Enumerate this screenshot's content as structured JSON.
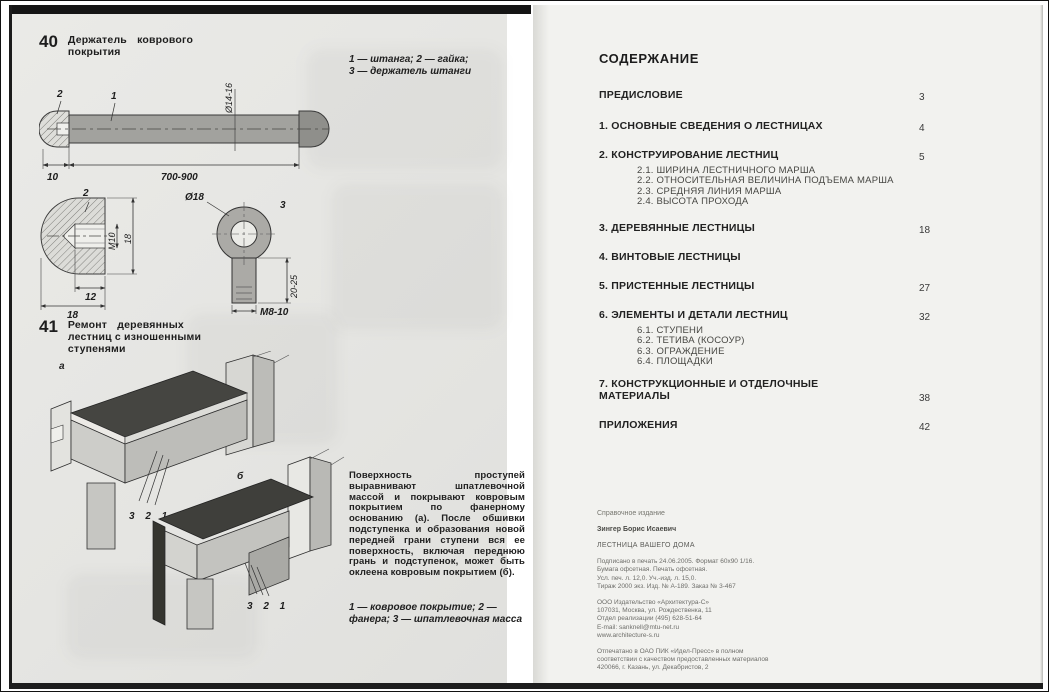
{
  "page_left": {
    "fig40": {
      "number": "40",
      "title_line1": "Держатель коврового",
      "title_line2": "покрытия",
      "legend_line1": "1 — штанга; 2 — гайка;",
      "legend_line2": "3 — держатель штанги",
      "rod": {
        "callout_1": "1",
        "callout_2": "2",
        "diameter": "Ø14-16",
        "end_len": "10",
        "length": "700-900"
      },
      "nut": {
        "callout": "2",
        "thread": "M10",
        "height": "18",
        "hole_width": "12",
        "width": "18"
      },
      "holder": {
        "callout": "3",
        "diameter": "Ø18",
        "stem_len": "20-25",
        "thread": "M8-10"
      }
    },
    "fig41": {
      "number": "41",
      "title_line1": "Ремонт деревянных",
      "title_line2": "лестниц с изношенными",
      "title_line3": "ступенями",
      "label_a": "а",
      "label_b": "б",
      "callouts_a": "3 2 1",
      "callouts_b": "3 2 1",
      "paragraph": "Поверхность проступей выравнивают шпатлевочной массой и покрывают ковровым покрытием по фанерному основанию (а). После обшивки подступенка и образования новой передней грани ступени вся ее поверхность, включая переднюю грань и подступенок, может быть оклеена ковровым покрытием (б).",
      "legend": "1 — ковровое покрытие; 2 — фанера; 3 — шпатлевочная масса"
    }
  },
  "page_right": {
    "heading": "СОДЕРЖАНИЕ",
    "toc": [
      {
        "label": "ПРЕДИСЛОВИЕ",
        "page": "3"
      },
      {
        "label": "1. ОСНОВНЫЕ СВЕДЕНИЯ О ЛЕСТНИЦАХ",
        "page": "4"
      },
      {
        "label": "2. КОНСТРУИРОВАНИЕ ЛЕСТНИЦ",
        "page": "5",
        "sub": [
          "2.1. ШИРИНА ЛЕСТНИЧНОГО МАРША",
          "2.2. ОТНОСИТЕЛЬНАЯ ВЕЛИЧИНА ПОДЪЕМА МАРША",
          "2.3. СРЕДНЯЯ ЛИНИЯ МАРША",
          "2.4. ВЫСОТА ПРОХОДА"
        ]
      },
      {
        "label": "3. ДЕРЕВЯННЫЕ ЛЕСТНИЦЫ",
        "page": "18"
      },
      {
        "label": "4. ВИНТОВЫЕ ЛЕСТНИЦЫ",
        "page": ""
      },
      {
        "label": "5. ПРИСТЕННЫЕ ЛЕСТНИЦЫ",
        "page": "27"
      },
      {
        "label": "6. ЭЛЕМЕНТЫ И ДЕТАЛИ ЛЕСТНИЦ",
        "page": "32",
        "sub": [
          "6.1. СТУПЕНИ",
          "6.2. ТЕТИВА (КОСОУР)",
          "6.3. ОГРАЖДЕНИЕ",
          "6.4. ПЛОЩАДКИ"
        ]
      },
      {
        "label": "7. КОНСТРУКЦИОННЫЕ И ОТДЕЛОЧНЫЕ МАТЕРИАЛЫ",
        "page": "38"
      },
      {
        "label": "ПРИЛОЖЕНИЯ",
        "page": "42"
      }
    ],
    "colophon": {
      "edition_type": "Справочное издание",
      "author": "Зингер Борис Исаевич",
      "book_title": "ЛЕСТНИЦА ВАШЕГО ДОМА",
      "print_info": [
        "Подписано в печать 24.06.2005. Формат 60х90 1/16.",
        "Бумага офсетная. Печать офсетная.",
        "Усл. печ. л. 12,0. Уч.-изд. л. 15,0.",
        "Тираж 2000 экз.   Изд. № А-189.   Заказ № 3-467"
      ],
      "publisher": [
        "ООО Издательство «Архитектура-С»",
        "107031, Москва, ул. Рождественка, 11",
        "Отдел реализации (495) 628-51-64",
        "E-mail: sanknell@mtu-net.ru",
        "www.architecture-s.ru"
      ],
      "printed_at": [
        "Отпечатано в ОАО ПИК «Идел-Пресс» в полном",
        "соответствии с качеством предоставленных материалов",
        "420066, г. Казань, ул. Декабристов, 2"
      ]
    }
  }
}
